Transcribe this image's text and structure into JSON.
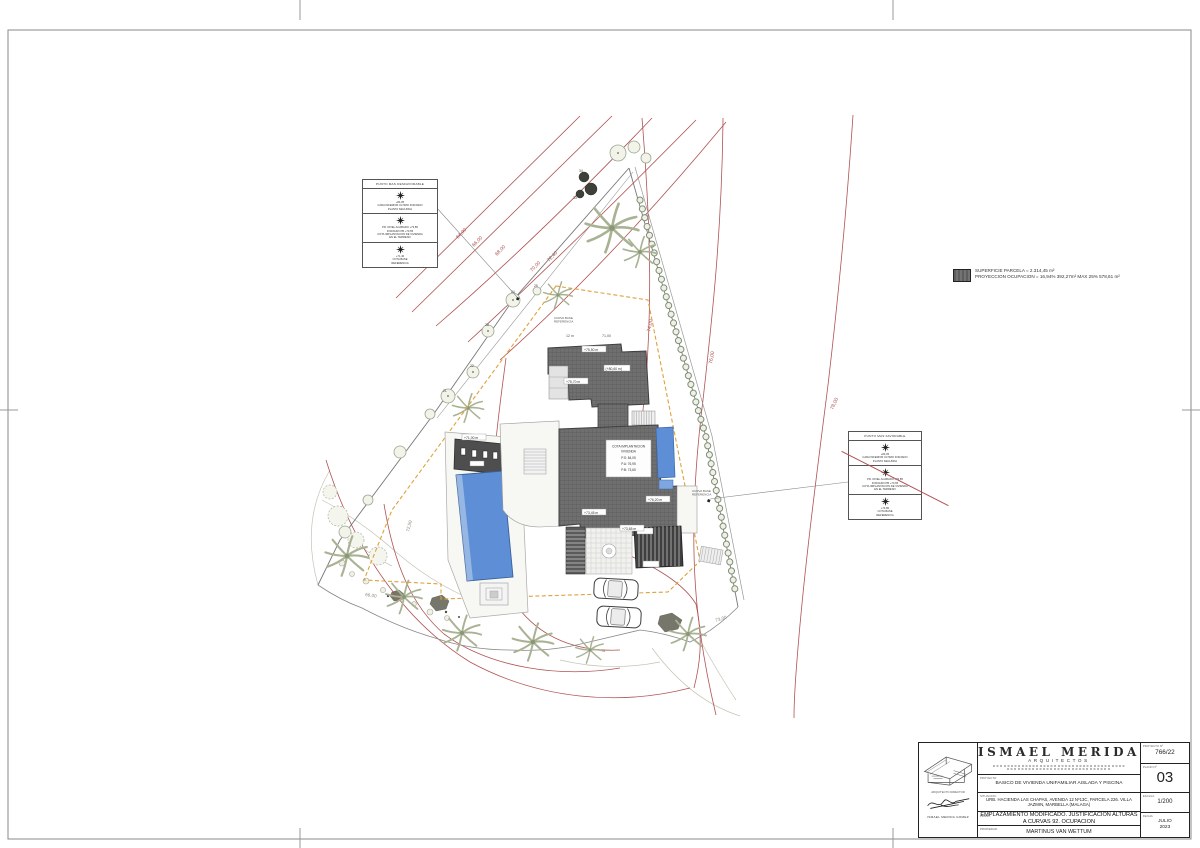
{
  "colors": {
    "contour": "#b05252",
    "setback": "#dfa13c",
    "pool": "#5e8fd6",
    "roof": "#6e6e6e"
  },
  "plan": {
    "legend": {
      "line1": "SUPERFICIE PARCELA = 2.314,45 m²",
      "line2": "PROYECCION OCUPACION = 16,94% 392,27m² MAX 25% 578,61 m²"
    },
    "box_left": {
      "title": "PUNTO MAS DESFAVORABLE",
      "c1a": "+84,05",
      "c1b": "CARA INFERIOR ULTIMO FORJADO",
      "c1c": "PLANTA SEGUNDA",
      "c2a": "PR. NIVEL ACABADO +73,85",
      "c2b": "FORJADO PB +73,65",
      "c2c": "COTA IMPLANTACION DE VIVIENDA",
      "c2d": "EN EL TERRENO",
      "c3a": "+71,40",
      "c3b": "COTA BASE",
      "c3c": "REFERENCIA"
    },
    "box_right": {
      "title": "PUNTO MAS FAVORABLE",
      "c1a": "+84,05",
      "c1b": "CARA INFERIOR ULTIMO FORJADO",
      "c1c": "PLANTA SEGUNDA",
      "c2a": "PR. NIVEL ACABADO +73,85",
      "c2b": "FORJADO PB +73,65",
      "c2c": "COTA IMPLANTACION DE VIVIENDA",
      "c2d": "EN EL TERRENO",
      "c3a": "+74,80",
      "c3b": "COTA BASE",
      "c3c": "REFERENCIA"
    },
    "contours": {
      "c64": "64,00",
      "c66": "66,00",
      "c68": "68,00",
      "c70": "70,00",
      "c7240": "72,40",
      "c74": "74,00",
      "c76": "76,00",
      "c78": "78,00",
      "c66b": "66,00",
      "c73": "73,00",
      "c7250": "72,50"
    },
    "elev": {
      "e1": "+75,50 m",
      "e2": "(+80,60 m)",
      "e3": "+75,70 m",
      "e4": "+76,20 m",
      "e5": "+73,45 m",
      "e6": "+73,65 m",
      "e7": "+71,00 m"
    },
    "dims": {
      "d1": "12 m",
      "d2": "71,00"
    },
    "ref": {
      "l1": "CURVA BASE",
      "l2": "REFERENCIA"
    },
    "levels": {
      "l1": "COTA IMPLANTACION",
      "l2": "VIVIENDA",
      "l3": "P.S: 84,05",
      "l4": "P.A: 76,95",
      "l5": "P.B: 73,65"
    },
    "trees": {
      "t21": "21",
      "t22": "22",
      "t23": "23",
      "t24": "24",
      "t25": "25",
      "t33": "33",
      "t34": "34"
    }
  },
  "title": {
    "firm": "ISMAEL MERIDA",
    "sub": "ARQUITECTOS",
    "dir_label": "ARQUITECTO DIRECTOR",
    "dir_name": "ISMAEL MERIDA GOMEZ",
    "proyecto_label": "PROYECTO:",
    "proyecto_value": "BASICO DE VIVIENDA UNIFAMILIAR AISLADA Y PISCINA",
    "situacion_label": "SITUACION:",
    "situacion_value": "URB. HACIENDA LAS CHAPAS, AVENIDA 12 Nº13C, PARCELA 226. VILLA JAZMIN, MARBELLA (MALAGA)",
    "plano_label": "PLANO:",
    "plano_value": "EMPLAZAMIENTO MODIFICADO. JUSTIFICACION ALTURAS A CURVAS 92. OCUPACION",
    "propiedad_label": "PROPIEDAD:",
    "propiedad_value": "MARTINUS VAN WETTUM",
    "no_label": "PROYECTO Nº",
    "no_value": "766/22",
    "plano_no_label": "PLANO Nº",
    "plano_no": "03",
    "escala_label": "ESCALA",
    "escala_value": "1/200",
    "fecha_label": "FECHA",
    "fecha_1": "JULIO",
    "fecha_2": "2023"
  }
}
